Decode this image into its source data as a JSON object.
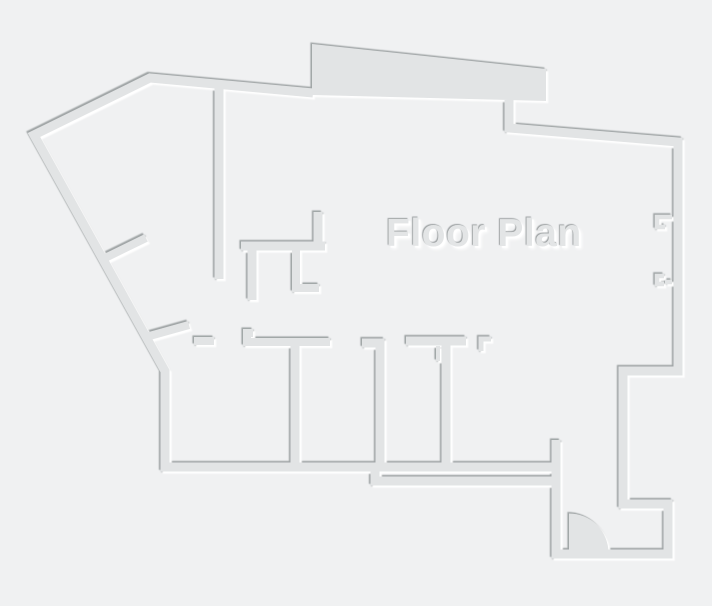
{
  "title": "Floor Plan",
  "canvas": {
    "width": 712,
    "height": 606
  },
  "colors": {
    "background": "#f0f1f2",
    "wall_fill": "#e2e4e5",
    "shadow_dark": "#979c9d",
    "shadow_light": "#ffffff",
    "title_color": "#e3e5e6"
  },
  "floor_plan": {
    "walls": [
      {
        "name": "outline-left-and-bottom",
        "w": 9,
        "points": [
          [
            313,
            93
          ],
          [
            150,
            78
          ],
          [
            34,
            135
          ],
          [
            165,
            371
          ],
          [
            165,
            467
          ],
          [
            552,
            467
          ]
        ]
      },
      {
        "name": "outline-right-and-door-wall",
        "w": 9,
        "points": [
          [
            509,
            100
          ],
          [
            509,
            128
          ],
          [
            678,
            142
          ],
          [
            678,
            371
          ],
          [
            623,
            371
          ],
          [
            623,
            504
          ],
          [
            668,
            504
          ],
          [
            668,
            554
          ],
          [
            556,
            554
          ],
          [
            556,
            440
          ]
        ]
      },
      {
        "name": "bottom-apron-wall",
        "w": 9,
        "points": [
          [
            375,
            470
          ],
          [
            375,
            481
          ],
          [
            552,
            481
          ]
        ]
      },
      {
        "name": "hall-divider-long",
        "w": 9,
        "points": [
          [
            219,
            88
          ],
          [
            219,
            279
          ]
        ]
      },
      {
        "name": "mid-room-top-wall",
        "w": 9,
        "points": [
          [
            241,
            246
          ],
          [
            325,
            246
          ]
        ]
      },
      {
        "name": "mid-room-upper-stub",
        "w": 9,
        "points": [
          [
            318,
            212
          ],
          [
            318,
            246
          ]
        ]
      },
      {
        "name": "mid-room-lower-stub-left",
        "w": 9,
        "points": [
          [
            252,
            248
          ],
          [
            252,
            300
          ]
        ]
      },
      {
        "name": "mid-room-lower-stub-right",
        "w": 8,
        "points": [
          [
            296,
            248
          ],
          [
            296,
            288
          ],
          [
            319,
            288
          ]
        ]
      },
      {
        "name": "diagonal-jamb-upper",
        "w": 8,
        "points": [
          [
            101,
            260
          ],
          [
            146,
            238
          ]
        ]
      },
      {
        "name": "diagonal-jamb-lower",
        "w": 8,
        "points": [
          [
            146,
            337
          ],
          [
            189,
            325
          ]
        ]
      },
      {
        "name": "room1-top-stub",
        "w": 8,
        "points": [
          [
            194,
            341
          ],
          [
            214,
            341
          ]
        ]
      },
      {
        "name": "room1-room2-top-wall",
        "w": 8,
        "points": [
          [
            253,
            333
          ],
          [
            247,
            333
          ],
          [
            247,
            342
          ],
          [
            330,
            342
          ]
        ]
      },
      {
        "name": "room-divider-1",
        "w": 9,
        "points": [
          [
            295,
            342
          ],
          [
            295,
            467
          ]
        ]
      },
      {
        "name": "room-divider-2-with-jamb",
        "w": 9,
        "points": [
          [
            362,
            343
          ],
          [
            380,
            343
          ],
          [
            380,
            467
          ]
        ]
      },
      {
        "name": "room3-top-wall",
        "w": 9,
        "points": [
          [
            406,
            341
          ],
          [
            466,
            341
          ]
        ]
      },
      {
        "name": "room-divider-3",
        "w": 9,
        "points": [
          [
            446,
            341
          ],
          [
            446,
            467
          ]
        ]
      },
      {
        "name": "room3-small-jamb",
        "w": 4,
        "points": [
          [
            438,
            346
          ],
          [
            438,
            361
          ]
        ]
      },
      {
        "name": "room4-entry-jamb",
        "w": 5,
        "points": [
          [
            491,
            339
          ],
          [
            481,
            339
          ],
          [
            481,
            351
          ]
        ]
      },
      {
        "name": "right-wall-recess-upper",
        "w": 4.5,
        "points": [
          [
            672,
            217
          ],
          [
            657,
            217
          ],
          [
            657,
            227
          ],
          [
            665,
            227
          ]
        ]
      },
      {
        "name": "right-wall-recess-lower-a",
        "w": 4.5,
        "points": [
          [
            664,
            276
          ],
          [
            657,
            276
          ],
          [
            657,
            284
          ],
          [
            664,
            284
          ]
        ]
      },
      {
        "name": "right-wall-recess-lower-b",
        "w": 4.5,
        "points": [
          [
            665,
            282
          ],
          [
            672,
            282
          ]
        ]
      }
    ],
    "band_polygon": [
      [
        312,
        44
      ],
      [
        546,
        69
      ],
      [
        546,
        101
      ],
      [
        312,
        95
      ]
    ],
    "door": {
      "hinge_x": 569,
      "hinge_y": 553,
      "radius": 39.5
    }
  }
}
